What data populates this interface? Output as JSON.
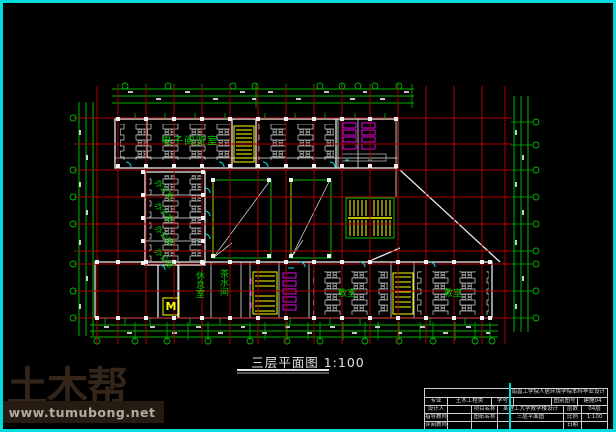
{
  "plan_title": {
    "name": "三层平面图",
    "scale": "1:100"
  },
  "rooms": {
    "reading_room": "电子阅览室",
    "office": "办公室",
    "rest_room": "休息室",
    "tea_room": "茶水间",
    "classroom_left": "教室",
    "classroom_right": "教室",
    "door_mark": "M"
  },
  "watermark": {
    "brand": "土木帮",
    "url": "www.tumubong.net"
  },
  "title_block": {
    "header": "南昌工学院人居环境学院本科毕业设计",
    "major_label": "专业",
    "major_value": "土木工程类",
    "student_no_label": "学号",
    "student_no_value": "",
    "doc_no_label": "图别图号",
    "doc_no_value": "建施04",
    "designer_label": "设计人",
    "designer_value": "",
    "project_label": "项目名称",
    "project_value": "某理工大学教学楼设计",
    "floors_label": "层数",
    "floors_value": "04层",
    "advisor_label": "指导教师",
    "advisor_value": "",
    "sheet_label": "图纸名称",
    "sheet_value": "三层平面图",
    "scale_label": "比例",
    "scale_value": "1:100",
    "reviewer_label": "评阅教师",
    "reviewer_value": "",
    "date_label": "日期",
    "date_value": ""
  },
  "colors": {
    "background": "#000000",
    "frame_cyan": "#00dcdc",
    "grid_red": "#a80000",
    "dim_green": "#00b400",
    "label_green": "#00cc00",
    "wall_white": "#e8e8e8",
    "stair_yellow": "#ffff00",
    "fixture_magenta": "#ff00ff",
    "watermark_brown": "#33251a"
  }
}
